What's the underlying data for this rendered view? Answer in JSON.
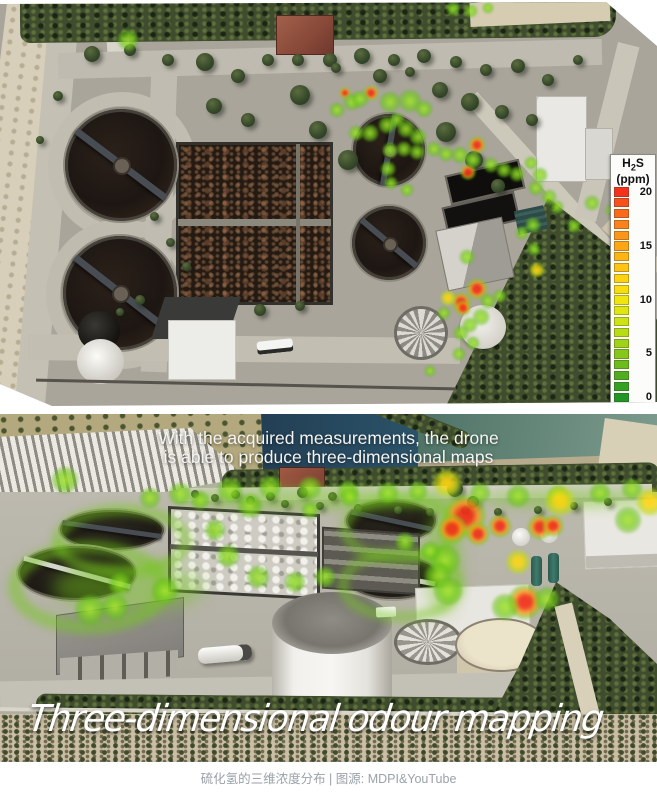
{
  "caption": "硫化氢的三维浓度分布 | 图源: MDPI&YouTube",
  "legend": {
    "title": {
      "pre": "H",
      "sub": "2",
      "post": "S"
    },
    "unit": "(ppm)",
    "ticks": [
      {
        "label": "20",
        "row": 0
      },
      {
        "label": "15",
        "row": 5
      },
      {
        "label": "10",
        "row": 10
      },
      {
        "label": "5",
        "row": 15
      },
      {
        "label": "0",
        "row": 19
      }
    ],
    "colors": [
      "#f5311c",
      "#f84f1b",
      "#fa6a19",
      "#fc8118",
      "#fd9517",
      "#fda515",
      "#feb513",
      "#fec411",
      "#fdd20f",
      "#f7dd0e",
      "#efe60d",
      "#e0e70f",
      "#cde312",
      "#b8dd15",
      "#a0d318",
      "#86c81a",
      "#6cbc1c",
      "#50ae1e",
      "#35a120",
      "#1f9722"
    ],
    "scale_range_ppm": [
      0,
      20
    ]
  },
  "top_map": {
    "description_units": "H2S ppm heat spots, [x,y,radius,ppm]",
    "heat_spots": [
      [
        128,
        38,
        11,
        5
      ],
      [
        345,
        91,
        6,
        14
      ],
      [
        352,
        100,
        9,
        4
      ],
      [
        337,
        108,
        8,
        4
      ],
      [
        371,
        91,
        8,
        18
      ],
      [
        360,
        97,
        9,
        5
      ],
      [
        390,
        100,
        11,
        5
      ],
      [
        410,
        99,
        12,
        5
      ],
      [
        424,
        107,
        9,
        4
      ],
      [
        397,
        118,
        8,
        4
      ],
      [
        387,
        123,
        9,
        5
      ],
      [
        370,
        131,
        9,
        5
      ],
      [
        356,
        131,
        8,
        4
      ],
      [
        406,
        127,
        9,
        6
      ],
      [
        418,
        135,
        9,
        5
      ],
      [
        390,
        148,
        8,
        5
      ],
      [
        404,
        147,
        8,
        5
      ],
      [
        417,
        150,
        8,
        5
      ],
      [
        388,
        167,
        8,
        4
      ],
      [
        391,
        181,
        7,
        4
      ],
      [
        407,
        188,
        7,
        4
      ],
      [
        434,
        147,
        8,
        4
      ],
      [
        446,
        152,
        8,
        5
      ],
      [
        453,
        7,
        7,
        3
      ],
      [
        471,
        9,
        7,
        3
      ],
      [
        488,
        6,
        6,
        3
      ],
      [
        477,
        143,
        9,
        18
      ],
      [
        468,
        170,
        8,
        17
      ],
      [
        460,
        153,
        9,
        5
      ],
      [
        473,
        158,
        8,
        5
      ],
      [
        491,
        163,
        8,
        5
      ],
      [
        504,
        168,
        8,
        4
      ],
      [
        517,
        172,
        8,
        5
      ],
      [
        531,
        161,
        7,
        4
      ],
      [
        540,
        173,
        8,
        5
      ],
      [
        536,
        186,
        8,
        5
      ],
      [
        549,
        195,
        8,
        4
      ],
      [
        557,
        205,
        7,
        4
      ],
      [
        592,
        201,
        8,
        4
      ],
      [
        612,
        208,
        7,
        4
      ],
      [
        574,
        224,
        7,
        5
      ],
      [
        533,
        223,
        8,
        5
      ],
      [
        522,
        231,
        7,
        5
      ],
      [
        537,
        268,
        8,
        12
      ],
      [
        534,
        247,
        7,
        5
      ],
      [
        467,
        255,
        8,
        8
      ],
      [
        477,
        287,
        11,
        19
      ],
      [
        461,
        300,
        10,
        18
      ],
      [
        448,
        296,
        8,
        13
      ],
      [
        463,
        306,
        8,
        16
      ],
      [
        488,
        299,
        8,
        6
      ],
      [
        500,
        294,
        7,
        5
      ],
      [
        481,
        315,
        9,
        5
      ],
      [
        470,
        323,
        8,
        6
      ],
      [
        461,
        331,
        8,
        6
      ],
      [
        473,
        341,
        7,
        5
      ],
      [
        459,
        352,
        7,
        4
      ],
      [
        444,
        311,
        7,
        5
      ],
      [
        430,
        369,
        6,
        4
      ]
    ]
  },
  "drone_view": {
    "subtitle_line1": "With the acquired measurements, the drone",
    "subtitle_line2": "is able to produce three-dimensional maps",
    "overlay_title": "Three-dimensional odour mapping",
    "heat_spots": [
      [
        65,
        66,
        14,
        5
      ],
      [
        150,
        84,
        11,
        5
      ],
      [
        180,
        80,
        12,
        5
      ],
      [
        200,
        86,
        10,
        4
      ],
      [
        230,
        76,
        13,
        5
      ],
      [
        270,
        73,
        12,
        4
      ],
      [
        310,
        74,
        12,
        4
      ],
      [
        348,
        77,
        11,
        4
      ],
      [
        388,
        79,
        11,
        4
      ],
      [
        418,
        77,
        10,
        4
      ],
      [
        447,
        69,
        15,
        12
      ],
      [
        480,
        79,
        11,
        4
      ],
      [
        518,
        82,
        12,
        5
      ],
      [
        558,
        82,
        11,
        4
      ],
      [
        600,
        79,
        11,
        4
      ],
      [
        632,
        75,
        11,
        4
      ],
      [
        650,
        88,
        15,
        11
      ],
      [
        560,
        87,
        16,
        10
      ],
      [
        628,
        106,
        14,
        8
      ],
      [
        465,
        102,
        22,
        19
      ],
      [
        452,
        115,
        15,
        17
      ],
      [
        478,
        120,
        12,
        14
      ],
      [
        500,
        112,
        12,
        17
      ],
      [
        540,
        113,
        13,
        16
      ],
      [
        553,
        112,
        11,
        14
      ],
      [
        518,
        148,
        13,
        11
      ],
      [
        445,
        146,
        16,
        6
      ],
      [
        438,
        162,
        14,
        6
      ],
      [
        448,
        177,
        15,
        7
      ],
      [
        405,
        128,
        10,
        5
      ],
      [
        430,
        137,
        10,
        5
      ],
      [
        250,
        92,
        13,
        5
      ],
      [
        215,
        116,
        11,
        5
      ],
      [
        228,
        142,
        12,
        5
      ],
      [
        258,
        163,
        12,
        5
      ],
      [
        295,
        168,
        11,
        4
      ],
      [
        325,
        163,
        11,
        4
      ],
      [
        165,
        177,
        14,
        5
      ],
      [
        120,
        170,
        12,
        5
      ],
      [
        90,
        196,
        16,
        6
      ],
      [
        115,
        193,
        14,
        6
      ],
      [
        350,
        83,
        10,
        4
      ],
      [
        310,
        96,
        9,
        4
      ],
      [
        525,
        188,
        18,
        17
      ],
      [
        505,
        193,
        14,
        6
      ],
      [
        547,
        185,
        13,
        6
      ]
    ]
  }
}
